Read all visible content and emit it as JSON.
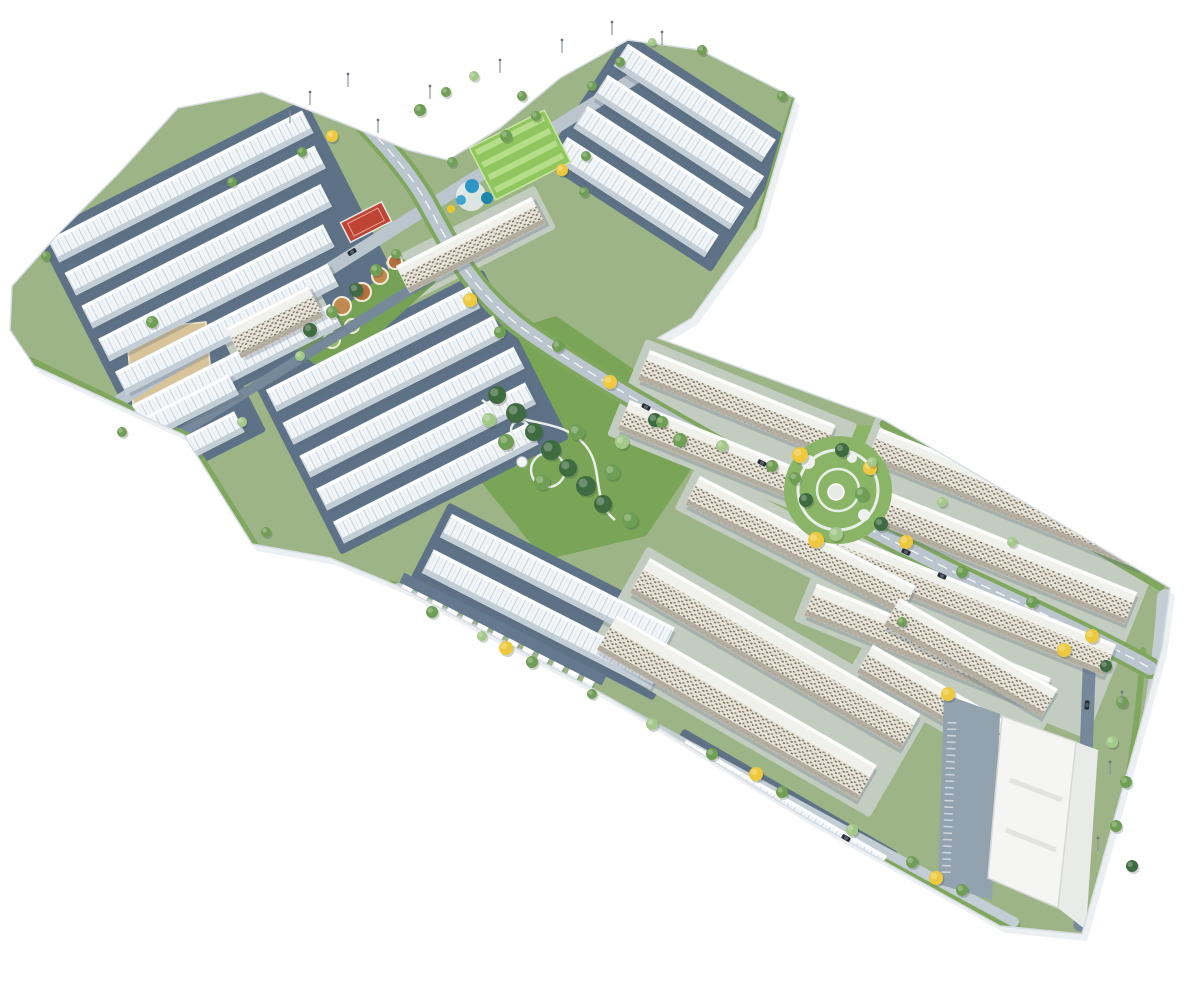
{
  "scene": {
    "width": 1200,
    "height": 1000,
    "background": "#ffffff",
    "colors": {
      "base": "#9db586",
      "site_edge": "#d7dde2",
      "site_shadow": "#edf0f2",
      "pad_town": "#5d7286",
      "pad_apt": "#c3ccc0",
      "roof_white": "#f3f6f8",
      "roof_line": "#c8d3da",
      "facade_town": "#bfcad3",
      "apt_base": "#e8e4d8",
      "apt_dot1": "#857d6e",
      "apt_dot2": "#6e675a",
      "apt_roof": "#f0f1ec",
      "road_main": "#bac5cd",
      "road_light": "#c2cdd4",
      "road_slate": "#76899b",
      "drive": "#64798d",
      "verge": "#7fa85e",
      "lawn": "#8ab566",
      "lawn_bright": "#8fc65e",
      "lawn_stripe": "#b7dc8a",
      "park": "#7aa556",
      "tree_dark": "#3f6b41",
      "tree_mid": "#6f9e55",
      "tree_light": "#a3c98a",
      "tree_yellow": "#eec93e",
      "court_red": "#bf4434",
      "pool_blue1": "#2e96c6",
      "pool_blue2": "#1f86ab",
      "pool_blue3": "#3fa6d0",
      "slide_yellow": "#e8c832",
      "plaza_tan": "#d9c398",
      "bed_brown1": "#b5703f",
      "bed_brown2": "#c08a4e",
      "path_white": "#e9eee9",
      "commercial": "#f5f5f3",
      "parking": "#93a2af",
      "car_dark": "#262c33",
      "lamp": "#8a949c"
    },
    "site_outline": [
      [
        178,
        108
      ],
      [
        262,
        92
      ],
      [
        350,
        126
      ],
      [
        408,
        150
      ],
      [
        448,
        160
      ],
      [
        500,
        128
      ],
      [
        560,
        78
      ],
      [
        628,
        40
      ],
      [
        700,
        50
      ],
      [
        795,
        98
      ],
      [
        757,
        228
      ],
      [
        692,
        318
      ],
      [
        658,
        338
      ],
      [
        884,
        420
      ],
      [
        1170,
        588
      ],
      [
        1162,
        648
      ],
      [
        1082,
        934
      ],
      [
        1000,
        926
      ],
      [
        806,
        818
      ],
      [
        610,
        698
      ],
      [
        398,
        586
      ],
      [
        330,
        558
      ],
      [
        252,
        544
      ],
      [
        184,
        435
      ],
      [
        34,
        366
      ],
      [
        10,
        330
      ],
      [
        12,
        286
      ],
      [
        60,
        232
      ],
      [
        120,
        172
      ]
    ],
    "clusters": [
      {
        "name": "northwest-townhouses",
        "x": 48,
        "y": 240,
        "angle": -27,
        "thick": 25,
        "pitch": 37,
        "type": "T",
        "lens": [
          285,
          280,
          268,
          252,
          238,
          222
        ]
      },
      {
        "name": "west-lower-townhouses",
        "x": 75,
        "y": 452,
        "angle": -27,
        "thick": 23,
        "pitch": 36,
        "type": "T",
        "lens": [
          172,
          160
        ]
      },
      {
        "name": "central-west-townhouses",
        "x": 266,
        "y": 390,
        "angle": -27,
        "thick": 24,
        "pitch": 37,
        "type": "T",
        "lens": [
          228,
          236,
          240,
          234,
          218
        ]
      },
      {
        "name": "central-apartment-slab",
        "x": 396,
        "y": 266,
        "angle": -27,
        "thick": 30,
        "pitch": 40,
        "type": "S",
        "lens": [
          152
        ]
      },
      {
        "name": "west-apartment-block",
        "x": 226,
        "y": 328,
        "angle": -27,
        "thick": 34,
        "pitch": 40,
        "type": "S",
        "lens": [
          92
        ]
      },
      {
        "name": "northeast-townhouses",
        "x": 628,
        "y": 44,
        "angle": 33,
        "thick": 26,
        "pitch": 37,
        "type": "T",
        "lens": [
          176,
          186,
          186,
          180
        ]
      },
      {
        "name": "mid-east-slabs",
        "x": 650,
        "y": 350,
        "angle": 22,
        "thick": 32,
        "pitch": 54,
        "type": "S",
        "lens": [
          200,
          212
        ]
      },
      {
        "name": "east-band-slabs",
        "x": 880,
        "y": 428,
        "angle": 22,
        "thick": 34,
        "pitch": 56,
        "type": "S",
        "lens": [
          292,
          300,
          300,
          252
        ]
      },
      {
        "name": "central-south-townhouses",
        "x": 452,
        "y": 514,
        "angle": 27,
        "thick": 26,
        "pitch": 40,
        "type": "T",
        "lens": [
          250,
          256
        ]
      },
      {
        "name": "south-upper-slab",
        "x": 700,
        "y": 476,
        "angle": 27,
        "thick": 32,
        "pitch": 48,
        "type": "S",
        "lens": [
          242
        ]
      },
      {
        "name": "south-slabs",
        "x": 650,
        "y": 558,
        "angle": 30,
        "thick": 40,
        "pitch": 66,
        "type": "S",
        "lens": [
          312,
          300
        ]
      },
      {
        "name": "south-edge-townhouses",
        "x": 686,
        "y": 740,
        "angle": 30,
        "thick": 28,
        "pitch": 40,
        "type": "T",
        "lens": [
          232
        ]
      },
      {
        "name": "southeast-slabs",
        "x": 900,
        "y": 598,
        "angle": 30,
        "thick": 32,
        "pitch": 54,
        "type": "S",
        "lens": [
          182,
          182
        ]
      }
    ],
    "comb": {
      "name": "edge-garage-units",
      "x": 402,
      "y": 586,
      "angle": 27,
      "count": 13,
      "step": 17,
      "w": 11,
      "h": 25
    },
    "lawns": [
      {
        "name": "east-wedge-lawn",
        "points": [
          [
            692,
            420
          ],
          [
            884,
            426
          ],
          [
            958,
            540
          ],
          [
            806,
            562
          ],
          [
            692,
            458
          ]
        ]
      },
      {
        "name": "central-park-lawn",
        "points": [
          [
            468,
            344
          ],
          [
            556,
            316
          ],
          [
            652,
            382
          ],
          [
            700,
            456
          ],
          [
            646,
            536
          ],
          [
            544,
            560
          ],
          [
            470,
            468
          ]
        ],
        "fill": "park"
      }
    ],
    "roads": [
      {
        "name": "service-road-west",
        "d": "M76,498 L468,254",
        "color": "road_slate",
        "w": 10
      },
      {
        "name": "avenue-northwest",
        "d": "M60,438 L644,72",
        "color": "road_main",
        "w": 13
      },
      {
        "name": "perimeter-lawn-south",
        "d": "M392,594 L1008,928",
        "color": "verge",
        "w": 26
      },
      {
        "name": "perimeter-road-south",
        "d": "M398,588 L1014,922",
        "color": "road_light",
        "w": 10
      },
      {
        "name": "edge-lawn-west",
        "d": "M30,362 L186,437 L254,546",
        "color": "verge",
        "w": 10
      },
      {
        "name": "edge-lawn-east",
        "d": "M884,424 L1160,586",
        "color": "verge",
        "w": 9
      },
      {
        "name": "edge-lawn-northeast",
        "d": "M795,100 L757,228",
        "color": "verge",
        "w": 7
      },
      {
        "name": "perimeter-road-east",
        "d": "M1166,598 C1160,700 1134,820 1098,930",
        "color": "road_light",
        "w": 18
      },
      {
        "name": "east-lawn-median",
        "d": "M1143,650 C1138,740 1118,840 1100,925",
        "color": "verge",
        "w": 6
      },
      {
        "name": "parking-lane-east",
        "d": "M1090,645 L1080,925",
        "color": "road_slate",
        "w": 13
      },
      {
        "name": "main-boulevard-verge",
        "d": "M345,102 C375,135 405,165 425,200 C450,245 470,290 525,330 C585,372 645,405 720,448 C800,494 880,535 960,575 C1040,612 1100,640 1150,668",
        "color": "verge",
        "w": 22
      },
      {
        "name": "main-boulevard",
        "d": "M345,102 C375,135 405,165 425,200 C450,245 470,290 525,330 C585,372 645,405 720,448 C800,494 880,535 960,575 C1040,612 1100,640 1150,668",
        "color": "road_main",
        "w": 14
      },
      {
        "name": "main-boulevard-centerline",
        "d": "M345,102 C375,135 405,165 425,200 C450,245 470,290 525,330 C585,372 645,405 720,448 C800,494 880,535 960,575 C1040,612 1100,640 1150,668",
        "color": "#ffffff",
        "w": 1.4,
        "dash": "9 7",
        "opacity": 0.8
      }
    ],
    "plaza": {
      "name": "sand-plaza",
      "points": [
        [
          126,
          330
        ],
        [
          206,
          322
        ],
        [
          214,
          406
        ],
        [
          134,
          414
        ]
      ]
    },
    "garden": {
      "name": "ornamental-garden",
      "points": [
        [
          296,
          348
        ],
        [
          402,
          258
        ],
        [
          436,
          282
        ],
        [
          330,
          378
        ]
      ],
      "beds": [
        [
          322,
          320,
          11,
          "b1"
        ],
        [
          342,
          306,
          9,
          "b2"
        ],
        [
          362,
          292,
          9,
          "b1"
        ],
        [
          380,
          276,
          8,
          "b2"
        ],
        [
          395,
          262,
          7,
          "b1"
        ],
        [
          332,
          340,
          8,
          "g"
        ],
        [
          352,
          326,
          7,
          "g"
        ]
      ]
    },
    "field": {
      "name": "sports-lawn",
      "cx": 520,
      "cy": 155,
      "rot": -27,
      "w": 84,
      "h": 58
    },
    "court": {
      "name": "red-court",
      "cx": 366,
      "cy": 222,
      "rot": -27,
      "w": 46,
      "h": 22
    },
    "pools": {
      "name": "aqua-park",
      "deck": [
        471,
        196,
        15
      ],
      "blobs": [
        [
          472,
          186,
          7,
          "pool_blue1"
        ],
        [
          487,
          198,
          6,
          "pool_blue2"
        ],
        [
          461,
          200,
          5,
          "pool_blue3"
        ],
        [
          451,
          209,
          4,
          "slide_yellow"
        ]
      ]
    },
    "central_park_paths": {
      "d1": "M482,400 C520,430 560,415 585,445 C605,468 590,500 615,520",
      "loop": [
        548,
        470,
        17
      ],
      "loop2": [
        520,
        430,
        9
      ],
      "tower": [
        522,
        462,
        5.5
      ]
    },
    "circular_park": {
      "name": "circular-garden",
      "cx": 838,
      "cy": 490,
      "r": 54,
      "ring1": 40,
      "ring2": 21,
      "blobs": [
        [
          808,
          462,
          7
        ],
        [
          864,
          515,
          6
        ],
        [
          852,
          458,
          5
        ]
      ],
      "center": [
        836,
        492,
        8
      ]
    },
    "commercial": {
      "name": "commercial-center",
      "box": [
        [
          1002,
          716
        ],
        [
          1076,
          742
        ],
        [
          1058,
          908
        ],
        [
          988,
          878
        ]
      ],
      "plaza": [
        [
          1076,
          742
        ],
        [
          1098,
          750
        ],
        [
          1086,
          930
        ],
        [
          1058,
          908
        ]
      ],
      "parking": [
        [
          944,
          694
        ],
        [
          1000,
          714
        ],
        [
          992,
          900
        ],
        [
          938,
          884
        ]
      ],
      "tick_line": "M952,722 L946,876"
    },
    "trees": [
      [
        497,
        395,
        9,
        "d"
      ],
      [
        516,
        413,
        10,
        "d"
      ],
      [
        534,
        432,
        9,
        "d"
      ],
      [
        551,
        450,
        10,
        "d"
      ],
      [
        568,
        468,
        9,
        "d"
      ],
      [
        586,
        486,
        10,
        "d"
      ],
      [
        603,
        504,
        9,
        "d"
      ],
      [
        506,
        442,
        8,
        "m"
      ],
      [
        542,
        482,
        8,
        "m"
      ],
      [
        577,
        432,
        8,
        "m"
      ],
      [
        612,
        472,
        8,
        "m"
      ],
      [
        489,
        420,
        7,
        "l"
      ],
      [
        622,
        442,
        7,
        "l"
      ],
      [
        630,
        520,
        8,
        "m"
      ],
      [
        655,
        420,
        7,
        "d"
      ],
      [
        680,
        440,
        7,
        "m"
      ],
      [
        800,
        455,
        8,
        "y"
      ],
      [
        870,
        468,
        7,
        "y"
      ],
      [
        816,
        540,
        8,
        "y"
      ],
      [
        881,
        524,
        7,
        "d"
      ],
      [
        842,
        450,
        7,
        "d"
      ],
      [
        806,
        500,
        7,
        "d"
      ],
      [
        862,
        494,
        7,
        "m"
      ],
      [
        836,
        534,
        7,
        "l"
      ],
      [
        795,
        478,
        6,
        "m"
      ],
      [
        470,
        300,
        7,
        "y"
      ],
      [
        500,
        332,
        6,
        "m"
      ],
      [
        558,
        346,
        6,
        "m"
      ],
      [
        610,
        382,
        7,
        "y"
      ],
      [
        662,
        422,
        6,
        "m"
      ],
      [
        722,
        446,
        6,
        "l"
      ],
      [
        772,
        466,
        6,
        "m"
      ],
      [
        906,
        542,
        7,
        "y"
      ],
      [
        962,
        572,
        6,
        "m"
      ],
      [
        1032,
        602,
        6,
        "m"
      ],
      [
        1092,
        636,
        7,
        "y"
      ],
      [
        420,
        110,
        6,
        "m"
      ],
      [
        446,
        92,
        5,
        "m"
      ],
      [
        474,
        76,
        5,
        "l"
      ],
      [
        332,
        136,
        6,
        "y"
      ],
      [
        302,
        152,
        5,
        "m"
      ],
      [
        506,
        136,
        6,
        "m"
      ],
      [
        536,
        116,
        5,
        "m"
      ],
      [
        562,
        170,
        6,
        "y"
      ],
      [
        584,
        192,
        5,
        "m"
      ],
      [
        310,
        330,
        7,
        "d"
      ],
      [
        332,
        312,
        6,
        "m"
      ],
      [
        356,
        290,
        7,
        "d"
      ],
      [
        376,
        270,
        6,
        "m"
      ],
      [
        300,
        356,
        5,
        "l"
      ],
      [
        396,
        254,
        5,
        "m"
      ],
      [
        452,
        162,
        5,
        "m"
      ],
      [
        522,
        96,
        5,
        "m"
      ],
      [
        586,
        156,
        5,
        "m"
      ],
      [
        46,
        256,
        5,
        "m"
      ],
      [
        232,
        182,
        5,
        "m"
      ],
      [
        152,
        322,
        6,
        "m"
      ],
      [
        122,
        432,
        5,
        "m"
      ],
      [
        242,
        422,
        5,
        "l"
      ],
      [
        266,
        532,
        5,
        "m"
      ],
      [
        432,
        612,
        6,
        "m"
      ],
      [
        482,
        636,
        5,
        "l"
      ],
      [
        532,
        662,
        6,
        "m"
      ],
      [
        592,
        694,
        5,
        "m"
      ],
      [
        652,
        724,
        6,
        "l"
      ],
      [
        712,
        754,
        6,
        "m"
      ],
      [
        782,
        792,
        6,
        "m"
      ],
      [
        852,
        830,
        6,
        "l"
      ],
      [
        912,
        862,
        6,
        "m"
      ],
      [
        962,
        890,
        6,
        "m"
      ],
      [
        506,
        648,
        7,
        "y"
      ],
      [
        756,
        774,
        7,
        "y"
      ],
      [
        936,
        878,
        7,
        "y"
      ],
      [
        1106,
        666,
        6,
        "d"
      ],
      [
        1122,
        702,
        6,
        "m"
      ],
      [
        1112,
        742,
        6,
        "l"
      ],
      [
        1126,
        782,
        6,
        "m"
      ],
      [
        1116,
        826,
        6,
        "m"
      ],
      [
        1132,
        866,
        6,
        "d"
      ],
      [
        1064,
        650,
        7,
        "y"
      ],
      [
        948,
        694,
        7,
        "y"
      ],
      [
        872,
        462,
        5,
        "l"
      ],
      [
        942,
        502,
        5,
        "l"
      ],
      [
        1012,
        542,
        5,
        "l"
      ],
      [
        902,
        622,
        5,
        "m"
      ],
      [
        620,
        62,
        5,
        "m"
      ],
      [
        592,
        86,
        5,
        "m"
      ],
      [
        652,
        42,
        4,
        "l"
      ],
      [
        702,
        50,
        5,
        "m"
      ],
      [
        782,
        96,
        5,
        "m"
      ]
    ],
    "lamps": [
      [
        310,
        92
      ],
      [
        348,
        74
      ],
      [
        500,
        60
      ],
      [
        562,
        40
      ],
      [
        612,
        22
      ],
      [
        662,
        32
      ],
      [
        290,
        110
      ],
      [
        430,
        86
      ],
      [
        378,
        120
      ],
      [
        1122,
        692
      ],
      [
        1110,
        762
      ],
      [
        1098,
        838
      ]
    ],
    "cars": [
      [
        646,
        407,
        28
      ],
      [
        762,
        463,
        27
      ],
      [
        942,
        576,
        25
      ],
      [
        1087,
        705,
        95
      ],
      [
        846,
        838,
        30
      ],
      [
        352,
        252,
        -32
      ],
      [
        906,
        552,
        25
      ]
    ]
  }
}
